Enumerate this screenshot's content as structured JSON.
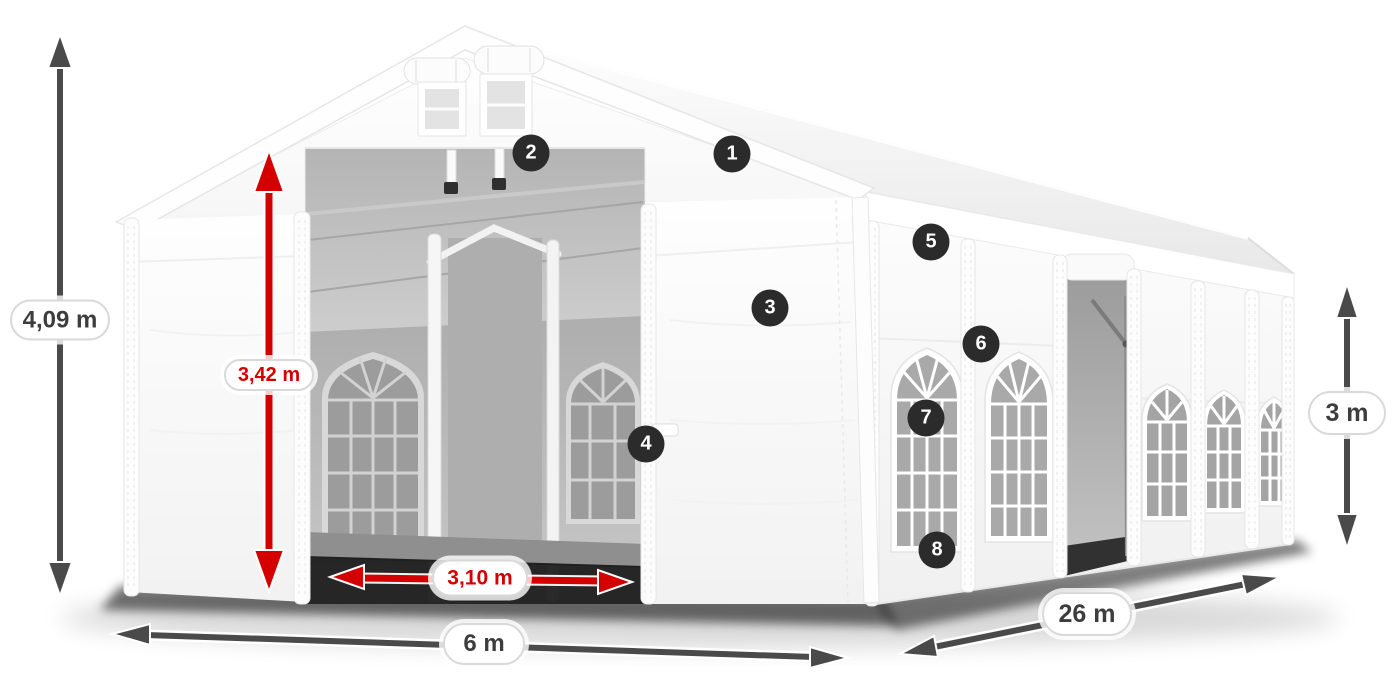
{
  "diagram": {
    "name": "party-tent-dimension-diagram",
    "subject": "white marquee tent 6 x 26 m with arched windows, open front entrance and numbered feature callouts",
    "measurements": {
      "ridge_height": "4,09 m",
      "entrance_height": "3,42 m",
      "entrance_width": "3,10 m",
      "front_width": "6 m",
      "side_length": "26 m",
      "wall_height": "3 m"
    },
    "callouts": [
      "1",
      "2",
      "3",
      "4",
      "5",
      "6",
      "7",
      "8"
    ],
    "colors": {
      "dimension_arrow_gray": "#4a4a4a",
      "dimension_arrow_red": "#d40000",
      "dimension_text_dark": "#3d3d3d",
      "dimension_text_red": "#d40000",
      "callout_background": "#2b2b2b",
      "callout_text": "#ffffff",
      "pill_background": "#ffffff",
      "pill_border": "#d9d9d9",
      "tent_fabric": "#ffffff",
      "interior_gray": "#a8a8a8"
    }
  }
}
